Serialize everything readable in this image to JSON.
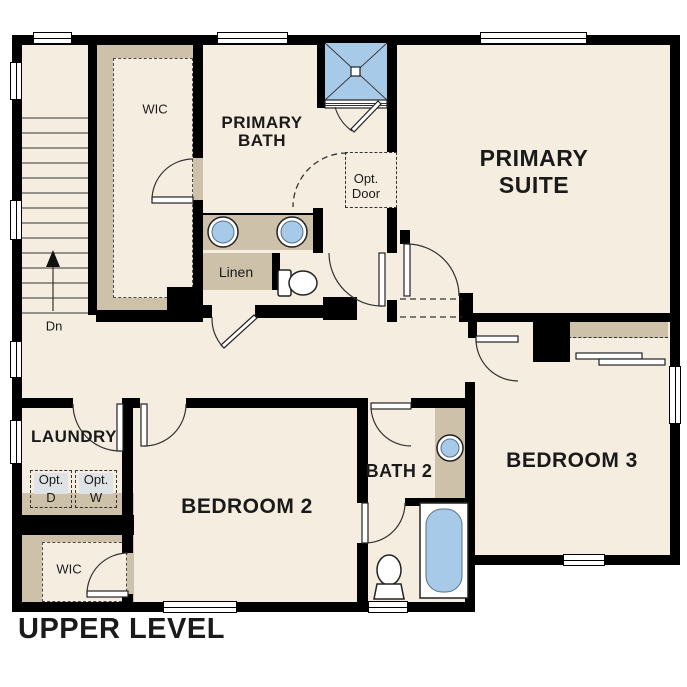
{
  "title": "UPPER LEVEL",
  "colors": {
    "floor": "#f5eee0",
    "wall": "#000000",
    "casework": "#cdc1a9",
    "fixture": "#a8cae9",
    "opt_shade": "#dfe3e6",
    "text": "#1a1a1a"
  },
  "rooms": {
    "wic_upper": {
      "label": "WIC"
    },
    "primary_bath": {
      "line1": "PRIMARY",
      "line2": "BATH"
    },
    "primary_suite": {
      "line1": "PRIMARY",
      "line2": "SUITE"
    },
    "linen": {
      "label": "Linen"
    },
    "laundry": {
      "label": "LAUNDRY"
    },
    "bedroom2": {
      "label": "BEDROOM 2"
    },
    "bath2": {
      "label": "BATH 2"
    },
    "bedroom3": {
      "label": "BEDROOM 3"
    },
    "wic_lower": {
      "label": "WIC"
    }
  },
  "annotations": {
    "opt_door": {
      "line1": "Opt.",
      "line2": "Door"
    },
    "stairs": {
      "label": "Dn"
    },
    "opt_dryer": {
      "line1": "Opt.",
      "line2": "D"
    },
    "opt_washer": {
      "line1": "Opt.",
      "line2": "W"
    }
  }
}
